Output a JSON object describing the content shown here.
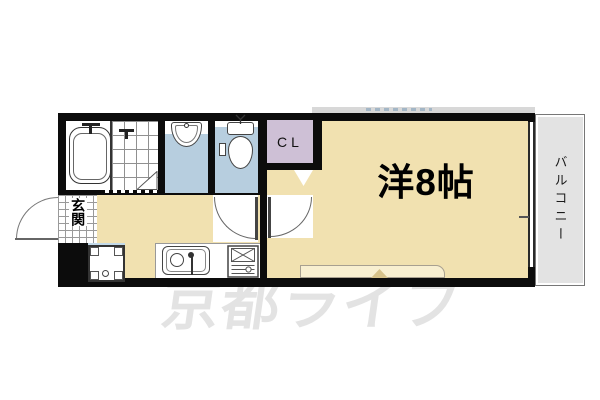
{
  "plan": {
    "type": "apartment-floorplan",
    "rooms": {
      "main_room": {
        "label": "洋8帖"
      },
      "balcony": {
        "label": "バルコニー"
      },
      "closet": {
        "label": "CL"
      },
      "entrance": {
        "label": "玄関"
      },
      "bathroom": {
        "fixtures": [
          "bathtub",
          "shower-tile-area"
        ]
      },
      "washroom": {
        "fixtures": [
          "washbasin"
        ]
      },
      "toilet": {
        "fixtures": [
          "toilet",
          "paper-holder"
        ]
      },
      "kitchen": {
        "fixtures": [
          "kitchen-sink",
          "gas-stove",
          "washing-machine-pan"
        ]
      }
    },
    "watermark": {
      "text": "京都ライフ"
    },
    "colors": {
      "wall": "#0c0c0c",
      "room_tan": "#f1e1b0",
      "wet_area_blue": "#b7cedf",
      "closet_purple": "#cec0d6",
      "balcony_gray": "#e3e3e3",
      "window_sill": "#f8efd0",
      "watermark_gray": "#e3e3e3"
    }
  }
}
